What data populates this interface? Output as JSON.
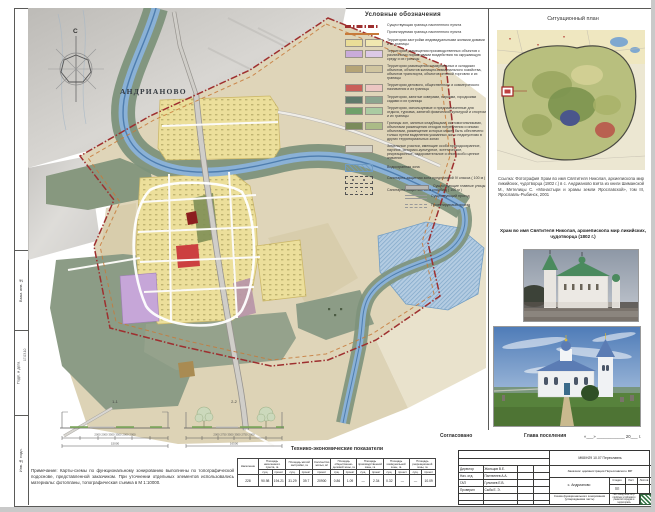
{
  "sheet_title": "Схема функционального зонирования М 1:5000",
  "map": {
    "north": "С",
    "settlement": "АНДРИАНОВО"
  },
  "legend": {
    "title": "Условные обозначения",
    "lines": [
      {
        "label": "Существующая граница населенного пункта",
        "color": "#9e2f2f"
      },
      {
        "label": "Проектируемая граница населенного пункта",
        "color": "#c77a3a"
      }
    ],
    "zones": [
      {
        "label": "Территории застройки индивидуальными жилыми домами и их границы",
        "colors": [
          "#eadd97",
          "#f0e7b0"
        ]
      },
      {
        "label": "Территории размещения производственных объектов с различными нормативами воздействия на окружающую среду и их границы",
        "colors": [
          "#c9abd9",
          "#dcc9e6"
        ]
      },
      {
        "label": "Территории размещения коммунальных и складских объектов, объектов жилищно-коммунального хозяйства, объектов транспорта, объектов оптовой торговли и их границы",
        "colors": [
          "#b5a476",
          "#d0c5a0"
        ]
      },
      {
        "label": "Территории делового, общественного и коммерческого назначения и их границы",
        "colors": [
          "#c95f5a",
          "#ecc6c2"
        ]
      },
      {
        "label": "Территории, занятые скверами, парками, городскими садами и их границы",
        "colors": [
          "#5f7a6b",
          "#8ba58f"
        ]
      },
      {
        "label": "Территории, используемые и предназначенные для отдыха, туризма, занятий физической культурой и спортом и их границы",
        "colors": [
          "#6fa06a",
          "#aacba2"
        ]
      },
      {
        "label": "Границы зон, занятых кладбищами, скотомогильниками, объектами размещения отходов потребления и иными объектами, размещение которых может быть обеспечено только путем выделения указанных зон и недопустимо в других территориальных зонах",
        "colors": [
          "#7b8b5b",
          "#abbb87"
        ]
      },
      {
        "label": "Земельные участки, имеющие особо природоохранное, научное, историко-культурное, эстетическое, рекреационное, оздоровительное и иное особо ценное значение",
        "colors": [
          "#d6d3c9"
        ]
      }
    ],
    "special": [
      {
        "label": "Водоохранная зона"
      },
      {
        "label": "Санитарно-защитная зона предприятий IV класса ( 100 м )"
      },
      {
        "label": "Санитарно-защитная зона кладбищ ( 100 м )"
      }
    ],
    "roads": [
      {
        "label": "Существующие главные улицы"
      },
      {
        "label": "Существующий проезд"
      },
      {
        "label": "Проектируемый проезд"
      }
    ]
  },
  "situational": {
    "title": "Ситуационный план"
  },
  "reference_text": "Ссылка: Фотография Храм во имя Святителя Николая, архиепископа мир ликийских, чудотворца (1802 г.) в с. Андрианово взята из книги Шиманской М., Метелицы С. «Монастыри и храмы земли Ярославской», том III, Ярославль-Рыбинск, 2001",
  "church_caption": "Храм во имя Святителя Николая, архиепископа мир ликийских, чудотворца (1802 г.)",
  "profiles": {
    "p1": {
      "label": "1-1",
      "dims": "2000    2000    3500    3500    2000    2000",
      "total": "15000"
    },
    "p2": {
      "label": "2-2",
      "dims": "2000    2750    3500    3500    2750    2000",
      "total": "16500"
    }
  },
  "approval": {
    "agreed": "Согласовано",
    "head": "Глава поселения",
    "date": "«___» ____________ 20___ г."
  },
  "tep": {
    "title": "Технико-экономические показатели",
    "col1": "Население",
    "columns": [
      "Площадь населенного пункта, га",
      "Площадь жилой застройки, га",
      "Количество жилья, м²",
      "Площадь общественно-деловой зоны, га",
      "Площадь производственной зоны, га",
      "Площадь коммунальной зоны, га",
      "Площадь рекреационной зоны, га"
    ],
    "sub_exist": "сущ.",
    "sub_plan": "проект",
    "values": {
      "population": "228",
      "area_settlement": [
        "90.98",
        "194.21"
      ],
      "area_housing": [
        "31.29",
        "39.7"
      ],
      "housing_qty": "20900",
      "area_business": [
        "0.86",
        "1.09"
      ],
      "area_industrial": [
        "—",
        "2.34"
      ],
      "area_communal": [
        "0.32",
        "—"
      ],
      "area_recreation": [
        "—",
        "10.09"
      ]
    }
  },
  "note": "Примечание: Карты-схемы по функциональному зонированию выполнены по топографической подоснове, представленной заказчиком. При уточнении отдельных элементов использовались материалы: фотопланы, топографическая съемка в М 1:10000.",
  "stamp": {
    "doc_code": "МК8/Н29 10.07 Переславль",
    "customer": "Заказчик: администрация Переславского МР",
    "place": "с. Андрианово",
    "stage_h": "Стадия",
    "sheet_h": "Лист",
    "sheets_h": "Листов",
    "stage_v": "ПП",
    "doc_name": "Схема функционального зонирования (утверждаемая часть)",
    "org": "НКО Фонд «Институт проблем устойчивого развития городов и территорий»",
    "rows": [
      {
        "role": "Директор",
        "name": "Жильцов В.Е."
      },
      {
        "role": "Нач. отд.",
        "name": "Пантелеев А.А."
      },
      {
        "role": "ГАП",
        "name": "Гультяев Е.В."
      },
      {
        "role": "Проверил",
        "name": "Сыба Е. Э."
      }
    ]
  },
  "margin": {
    "labels": [
      "Взам. инв. №",
      "Подп. и дата",
      "Инв. № подл."
    ],
    "date": "17.03.10"
  },
  "colors": {
    "river": "#8ab1d6",
    "residential": "#ecdf9b",
    "industrial": "#c6a6d8",
    "park": "#8c9c86",
    "commercial": "#cc4040",
    "boundary_existing": "#9e2f2f",
    "boundary_planned": "#c77a3a"
  }
}
